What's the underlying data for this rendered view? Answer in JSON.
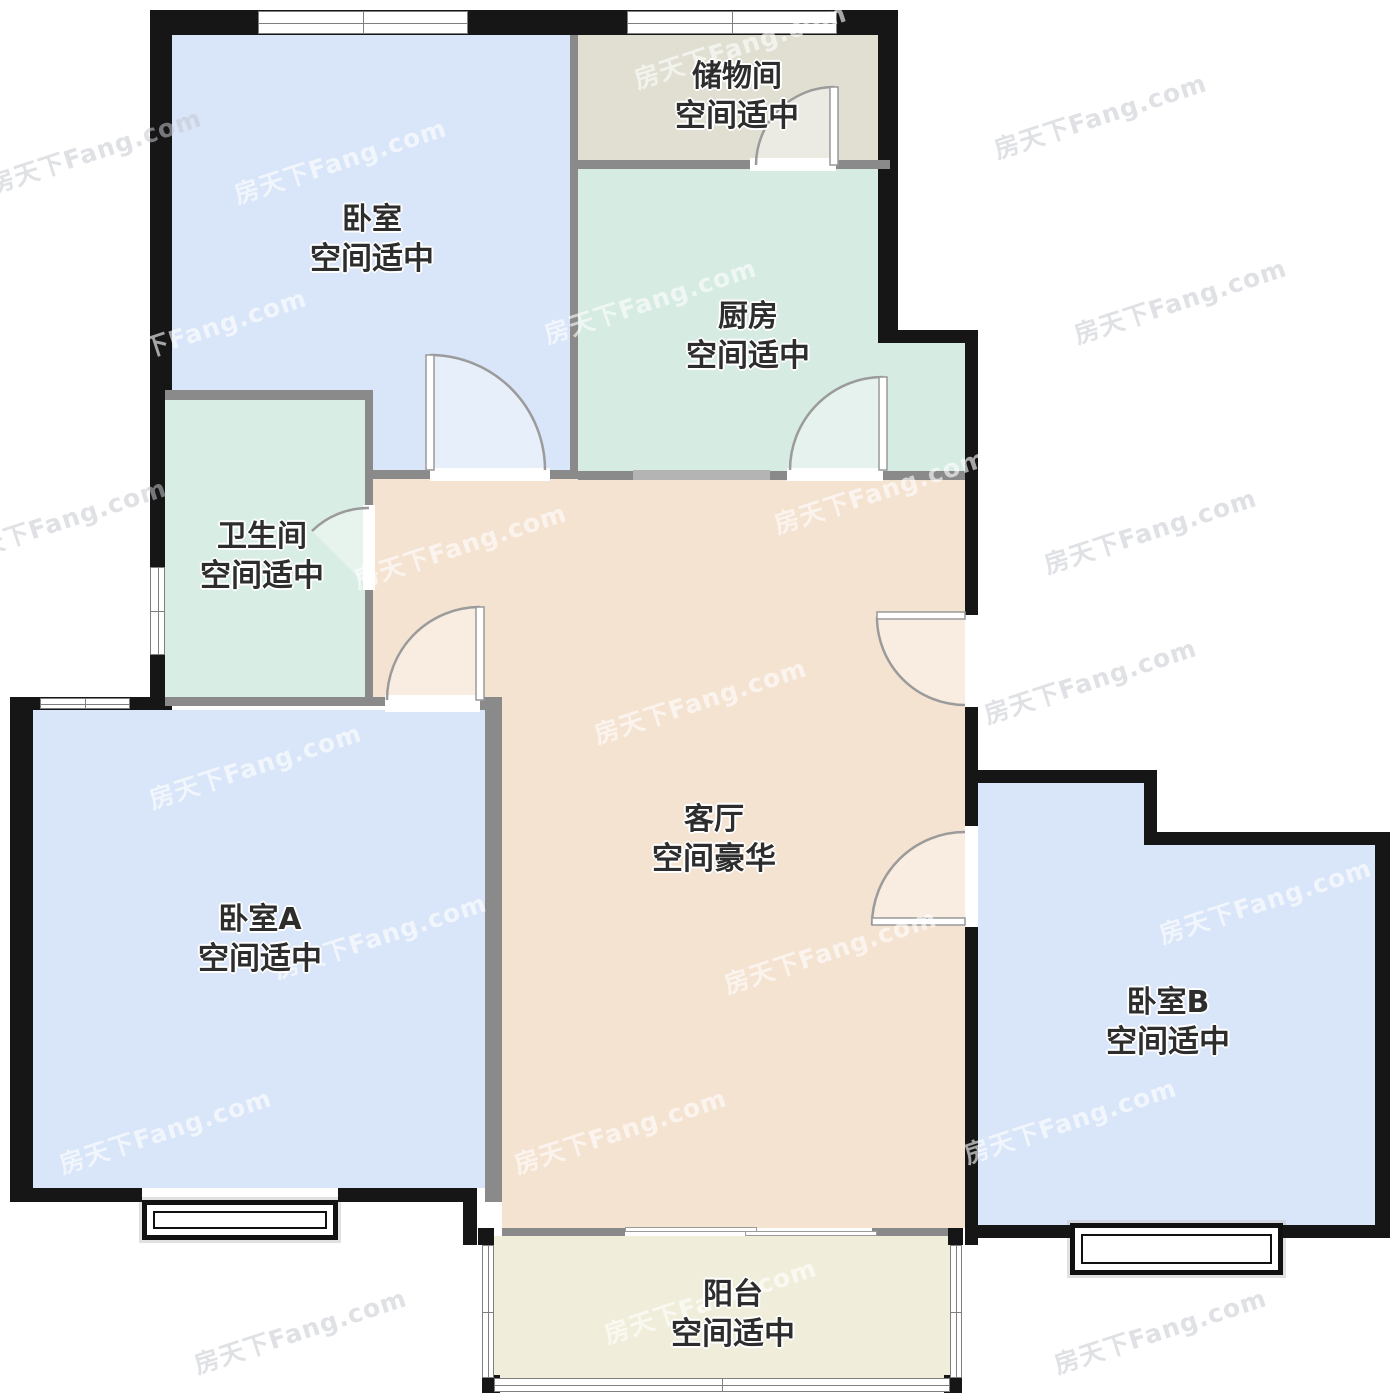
{
  "watermark": {
    "text": "房天下Fang.com",
    "instances": [
      {
        "x": 95,
        "y": 150,
        "v": "gray"
      },
      {
        "x": 340,
        "y": 160,
        "v": "light"
      },
      {
        "x": 740,
        "y": 45,
        "v": "light"
      },
      {
        "x": 1100,
        "y": 115,
        "v": "gray"
      },
      {
        "x": 200,
        "y": 330,
        "v": "light"
      },
      {
        "x": 650,
        "y": 300,
        "v": "light"
      },
      {
        "x": 1180,
        "y": 300,
        "v": "gray"
      },
      {
        "x": 60,
        "y": 520,
        "v": "gray"
      },
      {
        "x": 460,
        "y": 545,
        "v": "light"
      },
      {
        "x": 880,
        "y": 490,
        "v": "light"
      },
      {
        "x": 1150,
        "y": 530,
        "v": "gray"
      },
      {
        "x": 255,
        "y": 765,
        "v": "light"
      },
      {
        "x": 700,
        "y": 700,
        "v": "light"
      },
      {
        "x": 1090,
        "y": 680,
        "v": "gray"
      },
      {
        "x": 380,
        "y": 935,
        "v": "light"
      },
      {
        "x": 830,
        "y": 950,
        "v": "light"
      },
      {
        "x": 1265,
        "y": 900,
        "v": "light"
      },
      {
        "x": 165,
        "y": 1130,
        "v": "light"
      },
      {
        "x": 620,
        "y": 1130,
        "v": "light"
      },
      {
        "x": 1070,
        "y": 1120,
        "v": "light"
      },
      {
        "x": 300,
        "y": 1330,
        "v": "gray"
      },
      {
        "x": 710,
        "y": 1300,
        "v": "light"
      },
      {
        "x": 1160,
        "y": 1330,
        "v": "gray"
      }
    ]
  },
  "plan": {
    "colors": {
      "exterior_wall": "#161616",
      "interior_wall": "#8a8a8a",
      "pass_window": "#b4b4b4",
      "arc_stroke": "#9b9b9b"
    },
    "rooms": [
      {
        "id": "bedroom-top",
        "name": "卧室",
        "grade": "空间适中",
        "color": "#d9e5f8",
        "rects": [
          [
            172,
            35,
            398,
            355
          ],
          [
            373,
            390,
            197,
            80
          ]
        ],
        "label": [
          372,
          240
        ]
      },
      {
        "id": "storage",
        "name": "储物间",
        "grade": "空间适中",
        "color": "#e0dfd2",
        "rects": [
          [
            578,
            35,
            300,
            125
          ]
        ],
        "label": [
          737,
          97
        ]
      },
      {
        "id": "kitchen",
        "name": "厨房",
        "grade": "空间适中",
        "color": "#d6ebe2",
        "rects": [
          [
            578,
            169,
            300,
            302
          ],
          [
            878,
            343,
            87,
            128
          ]
        ],
        "label": [
          748,
          337
        ]
      },
      {
        "id": "bathroom",
        "name": "卫生间",
        "grade": "空间适中",
        "color": "#d8ede4",
        "rects": [
          [
            165,
            400,
            200,
            297
          ]
        ],
        "label": [
          262,
          557
        ]
      },
      {
        "id": "living",
        "name": "客厅",
        "grade": "空间豪华",
        "color": "#f5e3d1",
        "rects": [
          [
            373,
            479,
            592,
            218
          ],
          [
            502,
            697,
            463,
            531
          ]
        ],
        "label": [
          714,
          840
        ]
      },
      {
        "id": "bedroom-a",
        "name": "卧室A",
        "grade": "空间适中",
        "color": "#d9e5f8",
        "rects": [
          [
            33,
            710,
            452,
            478
          ]
        ],
        "label": [
          260,
          940
        ]
      },
      {
        "id": "bedroom-b",
        "name": "卧室B",
        "grade": "空间适中",
        "color": "#d9e5f8",
        "rects": [
          [
            978,
            783,
            166,
            442
          ],
          [
            1144,
            845,
            231,
            380
          ]
        ],
        "label": [
          1168,
          1023
        ]
      },
      {
        "id": "balcony",
        "name": "阳台",
        "grade": "空间适中",
        "color": "#f0eeda",
        "rects": [
          [
            494,
            1236,
            456,
            142
          ]
        ],
        "label": [
          733,
          1315
        ]
      }
    ],
    "exterior_walls": [
      [
        150,
        10,
        748,
        25
      ],
      [
        150,
        10,
        22,
        385
      ],
      [
        150,
        395,
        15,
        305
      ],
      [
        878,
        10,
        20,
        333
      ],
      [
        898,
        330,
        80,
        13
      ],
      [
        965,
        330,
        13,
        287
      ],
      [
        965,
        705,
        13,
        78
      ],
      [
        965,
        925,
        13,
        320
      ],
      [
        965,
        783,
        13,
        45
      ],
      [
        965,
        770,
        192,
        13
      ],
      [
        1144,
        770,
        13,
        75
      ],
      [
        1144,
        832,
        246,
        13
      ],
      [
        1375,
        832,
        15,
        406
      ],
      [
        978,
        1225,
        92,
        13
      ],
      [
        1283,
        1225,
        92,
        13
      ],
      [
        10,
        697,
        162,
        13
      ],
      [
        10,
        697,
        23,
        505
      ],
      [
        10,
        1188,
        132,
        14
      ],
      [
        338,
        1188,
        139,
        14
      ],
      [
        463,
        1188,
        14,
        57
      ],
      [
        478,
        1228,
        16,
        17
      ],
      [
        948,
        1228,
        15,
        17
      ],
      [
        482,
        1375,
        18,
        18
      ],
      [
        944,
        1375,
        18,
        18
      ]
    ],
    "interior_walls": [
      [
        570,
        35,
        8,
        130
      ],
      [
        578,
        160,
        312,
        9
      ],
      [
        570,
        165,
        8,
        306
      ],
      [
        373,
        470,
        57,
        9
      ],
      [
        550,
        470,
        28,
        9
      ],
      [
        578,
        471,
        55,
        9
      ],
      [
        770,
        471,
        17,
        9
      ],
      [
        883,
        471,
        82,
        9
      ],
      [
        165,
        390,
        208,
        10
      ],
      [
        365,
        395,
        8,
        302
      ],
      [
        165,
        697,
        220,
        9
      ],
      [
        480,
        697,
        22,
        13
      ],
      [
        485,
        697,
        17,
        505
      ],
      [
        502,
        1228,
        123,
        8
      ],
      [
        872,
        1228,
        76,
        8
      ]
    ],
    "pass_segments": [
      [
        633,
        470,
        137,
        10
      ]
    ],
    "door_gaps": [
      [
        430,
        468,
        120,
        13
      ],
      [
        787,
        468,
        96,
        13
      ],
      [
        750,
        158,
        86,
        13
      ],
      [
        363,
        505,
        12,
        85
      ],
      [
        385,
        695,
        95,
        17
      ],
      [
        965,
        615,
        13,
        92
      ],
      [
        965,
        826,
        13,
        101
      ]
    ],
    "windows": [
      {
        "rect": [
          258,
          11,
          210,
          23
        ],
        "orient": "h"
      },
      {
        "rect": [
          627,
          11,
          210,
          23
        ],
        "orient": "h"
      },
      {
        "rect": [
          150,
          567,
          15,
          88
        ],
        "orient": "v"
      },
      {
        "rect": [
          40,
          698,
          90,
          11
        ],
        "orient": "h"
      },
      {
        "rect": [
          482,
          1245,
          12,
          133
        ],
        "orient": "v"
      },
      {
        "rect": [
          950,
          1245,
          12,
          133
        ],
        "orient": "v"
      },
      {
        "rect": [
          494,
          1378,
          456,
          14
        ],
        "orient": "h"
      }
    ],
    "bay_windows": [
      {
        "outer": [
          142,
          1200,
          196,
          40
        ]
      },
      {
        "outer": [
          1070,
          1223,
          213,
          52
        ]
      }
    ],
    "sliding_door": [
      [
        625,
        1227,
        132,
        5
      ],
      [
        745,
        1231,
        132,
        5
      ]
    ],
    "doors": [
      {
        "id": "door-bedroom-top",
        "leaf": [
          426,
          355,
          8,
          115
        ],
        "wedge": "M430,470 L430,355 A115,115 0 0 1 545,470 Z",
        "arc": "M430,355 A115,115 0 0 1 545,470"
      },
      {
        "id": "door-kitchen",
        "leaf": [
          879,
          377,
          8,
          93
        ],
        "wedge": "M883,470 L883,377 A93,93 0 0 0 790,470 Z",
        "arc": "M883,377 A93,93 0 0 0 790,470"
      },
      {
        "id": "door-storage",
        "leaf": [
          830,
          87,
          8,
          78
        ],
        "wedge": "M834,165 L834,87 A78,78 0 0 0 756,165 Z",
        "arc": "M834,87 A78,78 0 0 0 756,165"
      },
      {
        "id": "door-bathroom",
        "leaf": null,
        "wedge": "M369,588 L369,508 A80,80 0 0 0 312,531 Z",
        "arc": "M369,508 A80,80 0 0 0 312,531"
      },
      {
        "id": "door-bedroom-a",
        "leaf": [
          476,
          607,
          8,
          93
        ],
        "wedge": "M480,700 L480,607 A93,93 0 0 0 387,700 Z",
        "arc": "M480,607 A93,93 0 0 0 387,700"
      },
      {
        "id": "door-entry",
        "leaf": [
          877,
          612,
          88,
          7
        ],
        "wedge": "M965,617 L877,617 A88,88 0 0 0 965,705 Z",
        "arc": "M877,617 A88,88 0 0 0 965,705"
      },
      {
        "id": "door-bedroom-b",
        "leaf": [
          872,
          918,
          93,
          7
        ],
        "wedge": "M965,925 L965,832 A93,93 0 0 0 872,925 Z",
        "arc": "M965,832 A93,93 0 0 0 872,925"
      }
    ]
  }
}
